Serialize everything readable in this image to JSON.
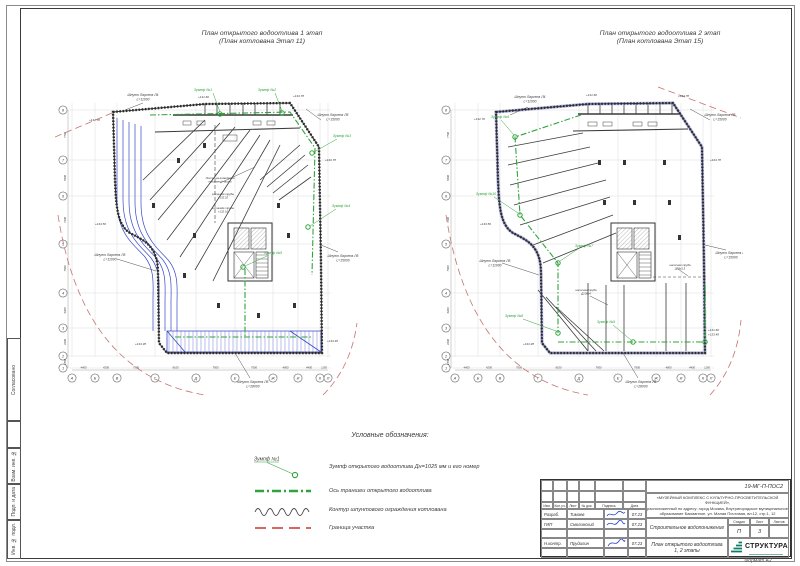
{
  "sheet": {
    "format_label": "Формат А2"
  },
  "margin_labels": [
    "Согласовано",
    "Взам. инв. №",
    "Подп. и дата",
    "Инв. № подл."
  ],
  "legend": {
    "title": "Условные обозначения:",
    "sump_tag": "Зумпф №1",
    "items": [
      {
        "name": "sump",
        "label": "Зумпф открытого водоотлива Дн=1025 мм и его номер"
      },
      {
        "name": "trench-axis",
        "label": "Ось траншеи открытого водоотлива"
      },
      {
        "name": "sheet-pile-contour",
        "label": "Контур шпунтового ограждения котлована"
      },
      {
        "name": "site-boundary",
        "label": "Граница участка"
      }
    ]
  },
  "plans": [
    {
      "title1": "План открытого водоотлива 1 этап",
      "title2": "(План котлована Этап 11)",
      "sumps": [
        "Зумпф №1",
        "Зумпф №2",
        "Зумпф №3",
        "Зумпф №4",
        "Зумпф №5"
      ],
      "piles": [
        [
          "Шпунт Ларсена Л4",
          "L=11000"
        ],
        [
          "Шпунт Ларсена Л5",
          "L=15000"
        ],
        [
          "Шпунт Ларсена Л5",
          "L=15000"
        ],
        [
          "Шпунт Ларсена Л5",
          "L=11000"
        ],
        [
          "Шпунт Ларсена Л5",
          "L=28000"
        ]
      ],
      "elevations": [
        "+131.60",
        "+133.78",
        "+132.70",
        "+133.78",
        "+133.50",
        "+133.38",
        "+133.48"
      ],
      "notes": [
        [
          "Лестница возведения",
          "подземной части"
        ],
        [
          "эстакада трубы",
          "+132.10"
        ],
        [
          "эстакада трубы",
          "+132.10"
        ]
      ],
      "axis_letters": [
        "А",
        "Б",
        "В",
        "Г",
        "Д",
        "Е",
        "Ж",
        "И",
        "К",
        "Л"
      ],
      "axis_numbers": [
        "8",
        "7",
        "6",
        "5",
        "4",
        "3",
        "2",
        "1"
      ],
      "dims_bottom": [
        "4400",
        "4200",
        "7500",
        "8100",
        "7500",
        "7500",
        "4800",
        "4400",
        "1150"
      ],
      "dims_left": [
        "7700",
        "5500",
        "7400",
        "7500",
        "5400",
        "4400",
        "1850"
      ]
    },
    {
      "title1": "План открытого водоотлива 2 этап",
      "title2": "(План котлована Этап 15)",
      "sumps": [
        "Зумпф №6",
        "Зумпф №10",
        "Зумпф №7",
        "Зумпф №8",
        "Зумпф №9"
      ],
      "piles": [
        [
          "Шпунт Ларсена Л4",
          "L=11000"
        ],
        [
          "Шпунт Ларсена Л5",
          "L=15000"
        ],
        [
          "Шпунт Ларсена Л5",
          "L=15000"
        ],
        [
          "Шпунт Ларсена Л5",
          "L=11000"
        ],
        [
          "Шпунт Ларсена Л5",
          "L=28000"
        ]
      ],
      "elevations": [
        "+131.60",
        "+133.78",
        "+132.70",
        "+133.78",
        "+133.50",
        "+133.38",
        "+131.60",
        "+133.48"
      ],
      "notes": [
        [
          "насосная труба",
          "Д89х3,5"
        ],
        [
          "насосная труба",
          "Д108х4"
        ]
      ],
      "axis_letters": [
        "А",
        "Б",
        "В",
        "Г",
        "Д",
        "Е",
        "Ж",
        "И",
        "К",
        "Л"
      ],
      "axis_numbers": [
        "8",
        "7",
        "6",
        "5",
        "4",
        "3",
        "2",
        "1"
      ],
      "dims_bottom": [
        "4400",
        "4200",
        "7500",
        "8100",
        "7500",
        "7500",
        "4800",
        "4400",
        "1150"
      ],
      "dims_left": [
        "7700",
        "5500",
        "7400",
        "7500",
        "5400",
        "4400",
        "1850"
      ]
    }
  ],
  "title_block": {
    "code": "19-МГ-П-ПОС2",
    "project_l1": "«МУЗЕЙНЫЙ КОМПЛЕКС С КУЛЬТУРНО-ПРОСВЕТИТЕЛЬСКОЙ ФУНКЦИЕЙ»,",
    "project_l2": "расположенный по адресу: город Москва, Внутригородское муниципальное",
    "project_l3": "образование Басманное, ул. Малая Почтовая, вл.12, стр.1, 12",
    "doc_title": "Строительное водопонижение",
    "sheet_title_l1": "План открытого водоотлива",
    "sheet_title_l2": "1, 2 этапы",
    "header_cols": [
      "Изм.",
      "Кол.уч.",
      "Лист",
      "№ док.",
      "Подпись",
      "Дата"
    ],
    "stage_header": "Стадия",
    "sheet_header": "Лист",
    "sheets_header": "Листов",
    "stage": "П",
    "sheet_no": "3",
    "rows": [
      {
        "role": "Разраб.",
        "name": "Тимаев",
        "date": "07.23"
      },
      {
        "role": "ГИП",
        "name": "Смолинский",
        "date": "07.23"
      },
      {
        "role": "Н.контр.",
        "name": "Прудилин",
        "date": "07.23"
      }
    ],
    "company": "СТРУКТУРА"
  },
  "colors": {
    "green": "#2fa43b",
    "blue": "#3847c8",
    "boundary_red": "#c4736f",
    "legend_red": "#cc3333",
    "logo_teal": "#0c7c6a"
  }
}
